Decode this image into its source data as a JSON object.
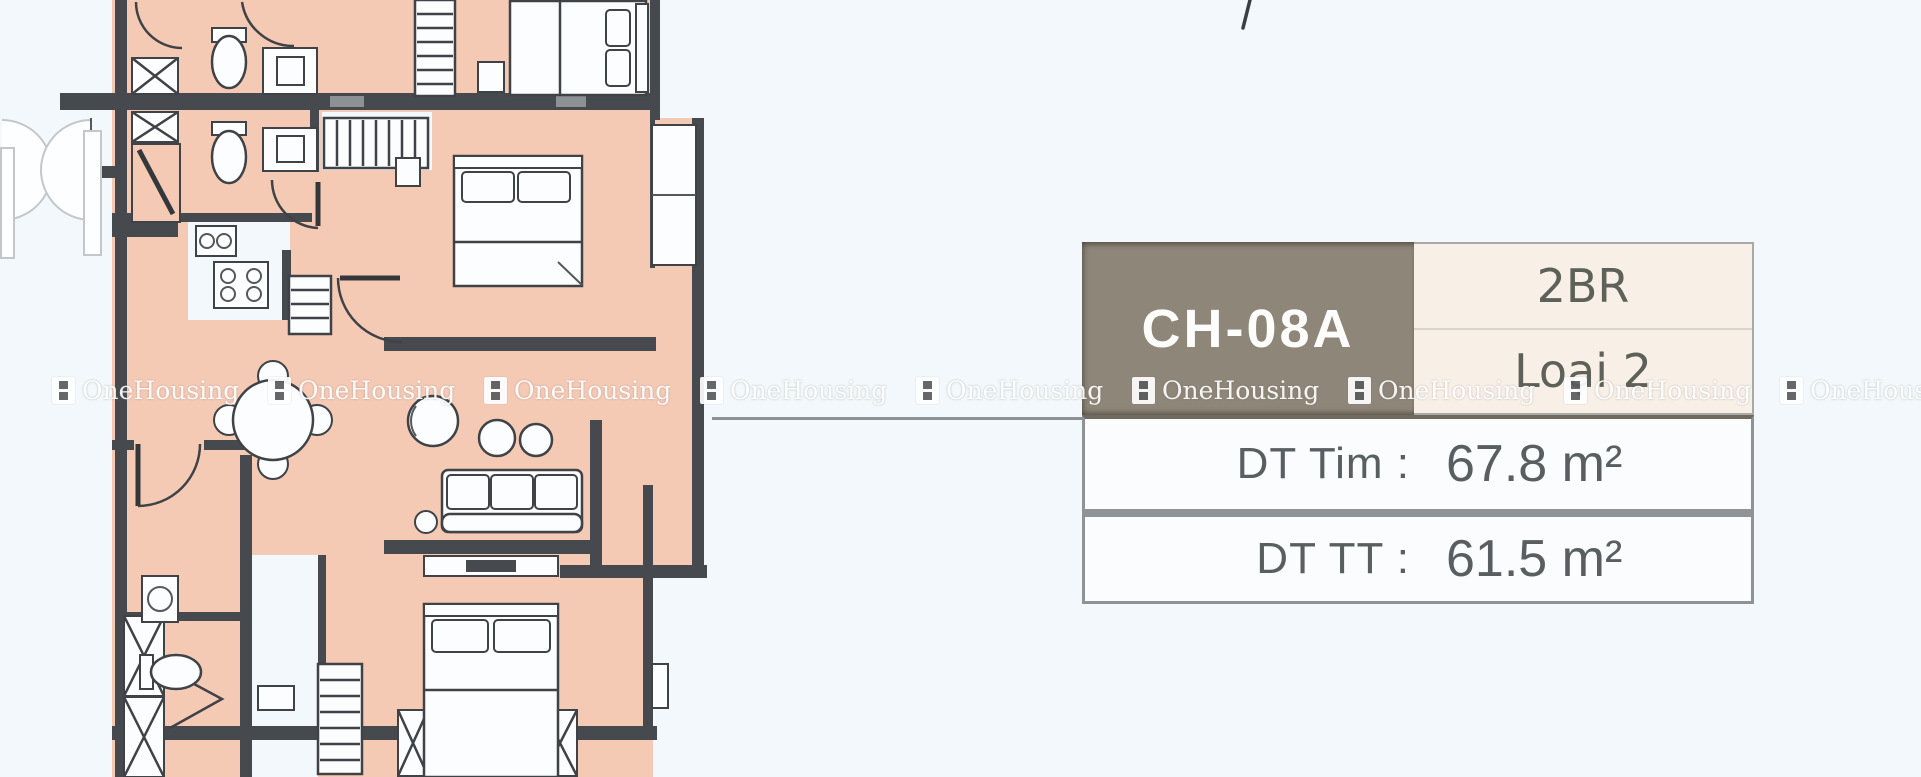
{
  "colors": {
    "background": "#f2f8fb",
    "room_fill": "#f5cab5",
    "wall": "#46494d",
    "card_header_bg": "#8e8678",
    "card_header_text": "#fdfdfc",
    "card_cream_bg": "#f8f0e7",
    "card_row_bg": "#fafcfd",
    "card_border": "#8f9395",
    "card_text": "#595e61",
    "leader_line": "#8d9194",
    "watermark_text": "#ffffff"
  },
  "floor_plan": {
    "kind": "apartment-floor-plan",
    "rooms": [
      "bedroom-top",
      "bedroom-middle",
      "bedroom-bottom",
      "living-dining",
      "kitchen",
      "bathroom-top",
      "bathroom-middle",
      "bathroom-bottom",
      "hallway",
      "balcony",
      "service-shafts"
    ]
  },
  "leader_line": {
    "from_x": 712,
    "from_y": 417,
    "to_x": 1082,
    "to_y": 417
  },
  "watermark": {
    "text": "OneHousing",
    "row_y": 376,
    "positions": [
      52,
      268,
      484,
      700,
      916,
      1132,
      1348,
      1564,
      1780
    ]
  },
  "card": {
    "unit_code": "CH-08A",
    "bedroom_type": "2BR",
    "layout_type": "Loại 2",
    "rows": [
      {
        "label": "DT Tim :",
        "value": "67.8 m²"
      },
      {
        "label": "DT TT :",
        "value": "61.5 m²"
      }
    ]
  }
}
